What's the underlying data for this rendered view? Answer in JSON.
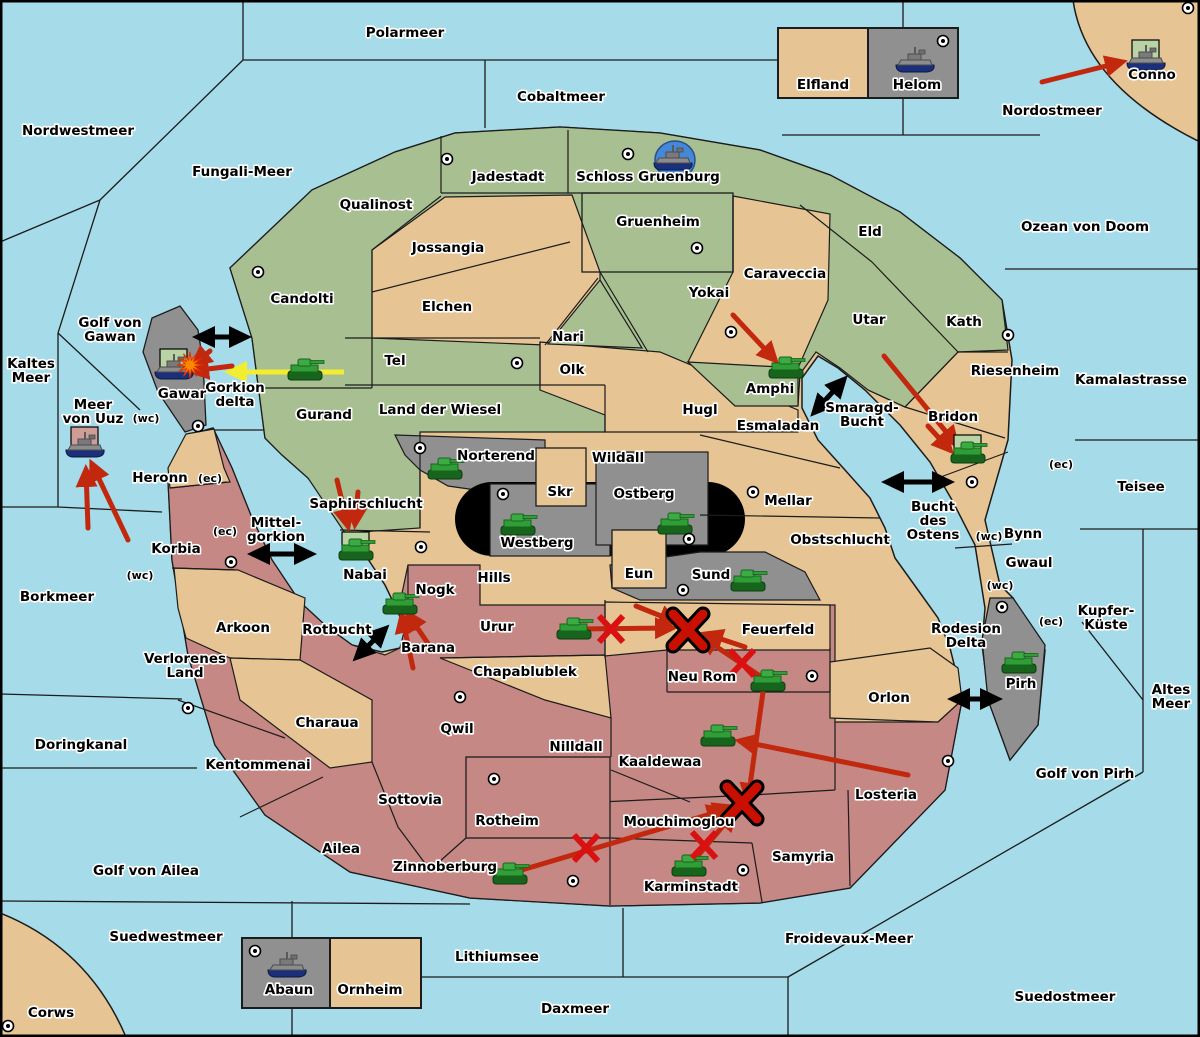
{
  "map": {
    "title": "Diplomacy-style war map",
    "colors": {
      "sea": "#a6dbe9",
      "land_tan": "#e6c493",
      "land_green": "#a8bf92",
      "land_pink": "#c58885",
      "land_gray": "#909090",
      "black_zone": "#000000",
      "border": "#1c1c1c",
      "arrow_red": "#c1280e",
      "arrow_yellow": "#f2ed2f",
      "arrow_black": "#000000",
      "x_mark": "#d91111",
      "x_mark_big": "#c90f00",
      "unit_box_green": "#b9d3a5",
      "unit_box_pink": "#cf9d97",
      "tank_green": "#2f9e36",
      "ship_gray": "#8c8c8c",
      "ship_hull_blue": "#1b2f7a",
      "port_circle_blue": "#4687d8",
      "explosion_orange": "#ff8a00"
    },
    "sea_labels": [
      {
        "t": [
          "Polarmeer"
        ],
        "x": 405,
        "y": 37
      },
      {
        "t": [
          "Nordwestmeer"
        ],
        "x": 78,
        "y": 135
      },
      {
        "t": [
          "Cobaltmeer"
        ],
        "x": 561,
        "y": 101
      },
      {
        "t": [
          "Nordostmeer"
        ],
        "x": 1052,
        "y": 115
      },
      {
        "t": [
          "Fungali-Meer"
        ],
        "x": 242,
        "y": 176
      },
      {
        "t": [
          "Ozean von Doom"
        ],
        "x": 1085,
        "y": 231
      },
      {
        "t": [
          "Golf von",
          "Gawan"
        ],
        "x": 110,
        "y": 327
      },
      {
        "t": [
          "Kaltes",
          "Meer"
        ],
        "x": 31,
        "y": 368
      },
      {
        "t": [
          "Meer",
          "von Uuz"
        ],
        "x": 93,
        "y": 409
      },
      {
        "t": [
          "Gorkion",
          "delta"
        ],
        "x": 235,
        "y": 392
      },
      {
        "t": [
          "Kamalastrasse"
        ],
        "x": 1131,
        "y": 384
      },
      {
        "t": [
          "Smaragd-",
          "Bucht"
        ],
        "x": 862,
        "y": 412
      },
      {
        "t": [
          "Teisee"
        ],
        "x": 1141,
        "y": 491
      },
      {
        "t": [
          "Bucht",
          "des",
          "Ostens"
        ],
        "x": 933,
        "y": 511
      },
      {
        "t": [
          "Mittel-",
          "gorkion"
        ],
        "x": 276,
        "y": 527
      },
      {
        "t": [
          "Borkmeer"
        ],
        "x": 57,
        "y": 601
      },
      {
        "t": [
          "Rotbucht"
        ],
        "x": 337,
        "y": 634
      },
      {
        "t": [
          "Rodesion",
          "Delta"
        ],
        "x": 966,
        "y": 633
      },
      {
        "t": [
          "Kupfer-",
          "Küste"
        ],
        "x": 1106,
        "y": 615
      },
      {
        "t": [
          "Altes",
          "Meer"
        ],
        "x": 1171,
        "y": 694
      },
      {
        "t": [
          "Doringkanal"
        ],
        "x": 81,
        "y": 749
      },
      {
        "t": [
          "Golf von Pirh"
        ],
        "x": 1085,
        "y": 778
      },
      {
        "t": [
          "Golf von Ailea"
        ],
        "x": 146,
        "y": 875
      },
      {
        "t": [
          "Suedwestmeer"
        ],
        "x": 166,
        "y": 941
      },
      {
        "t": [
          "Froidevaux-Meer"
        ],
        "x": 849,
        "y": 943
      },
      {
        "t": [
          "Lithiumsee"
        ],
        "x": 497,
        "y": 961
      },
      {
        "t": [
          "Daxmeer"
        ],
        "x": 575,
        "y": 1013
      },
      {
        "t": [
          "Corws"
        ],
        "x": 51,
        "y": 1017
      },
      {
        "t": [
          "Suedostmeer"
        ],
        "x": 1065,
        "y": 1001
      }
    ],
    "territory_labels": [
      {
        "t": [
          "Candolti"
        ],
        "x": 302,
        "y": 303,
        "color": "green"
      },
      {
        "t": [
          "Qualinost"
        ],
        "x": 376,
        "y": 209,
        "color": "green"
      },
      {
        "t": [
          "Jadestadt"
        ],
        "x": 508,
        "y": 181,
        "color": "green"
      },
      {
        "t": [
          "Schloss Gruenburg"
        ],
        "x": 648,
        "y": 181,
        "color": "green"
      },
      {
        "t": [
          "Gruenheim"
        ],
        "x": 658,
        "y": 226,
        "color": "green"
      },
      {
        "t": [
          "Jossangia"
        ],
        "x": 448,
        "y": 252,
        "color": "tan"
      },
      {
        "t": [
          "Elchen"
        ],
        "x": 447,
        "y": 311,
        "color": "tan"
      },
      {
        "t": [
          "Nari"
        ],
        "x": 568,
        "y": 341,
        "color": "green"
      },
      {
        "t": [
          "Olk"
        ],
        "x": 572,
        "y": 374,
        "color": "tan"
      },
      {
        "t": [
          "Tel"
        ],
        "x": 395,
        "y": 365,
        "color": "green"
      },
      {
        "t": [
          "Land der Wiesel"
        ],
        "x": 440,
        "y": 414,
        "color": "green"
      },
      {
        "t": [
          "Gurand"
        ],
        "x": 324,
        "y": 419,
        "color": "green"
      },
      {
        "t": [
          "Yokai"
        ],
        "x": 709,
        "y": 297,
        "color": "green"
      },
      {
        "t": [
          "Caraveccia"
        ],
        "x": 785,
        "y": 278,
        "color": "tan"
      },
      {
        "t": [
          "Eld"
        ],
        "x": 870,
        "y": 236,
        "color": "green"
      },
      {
        "t": [
          "Utar"
        ],
        "x": 869,
        "y": 324,
        "color": "green"
      },
      {
        "t": [
          "Kath"
        ],
        "x": 964,
        "y": 326,
        "color": "green"
      },
      {
        "t": [
          "Amphi"
        ],
        "x": 770,
        "y": 393,
        "color": "green"
      },
      {
        "t": [
          "Riesenheim"
        ],
        "x": 1015,
        "y": 375,
        "color": "tan"
      },
      {
        "t": [
          "Bridon"
        ],
        "x": 953,
        "y": 421,
        "color": "tan"
      },
      {
        "t": [
          "Bynn"
        ],
        "x": 1023,
        "y": 538,
        "color": "tan"
      },
      {
        "t": [
          "Gwaul"
        ],
        "x": 1029,
        "y": 567,
        "color": "tan"
      },
      {
        "t": [
          "Hugl"
        ],
        "x": 700,
        "y": 414,
        "color": "tan"
      },
      {
        "t": [
          "Esmaladan"
        ],
        "x": 778,
        "y": 430,
        "color": "tan"
      },
      {
        "t": [
          "Wildall"
        ],
        "x": 618,
        "y": 462,
        "color": "tan"
      },
      {
        "t": [
          "Mellar"
        ],
        "x": 788,
        "y": 505,
        "color": "tan"
      },
      {
        "t": [
          "Obstschlucht"
        ],
        "x": 840,
        "y": 544,
        "color": "tan"
      },
      {
        "t": [
          "Norterend"
        ],
        "x": 496,
        "y": 460,
        "color": "gray"
      },
      {
        "t": [
          "Skr"
        ],
        "x": 560,
        "y": 496,
        "color": "tan"
      },
      {
        "t": [
          "Ostberg"
        ],
        "x": 644,
        "y": 498,
        "color": "gray"
      },
      {
        "t": [
          "Westberg"
        ],
        "x": 537,
        "y": 547,
        "color": "gray"
      },
      {
        "t": [
          "Eun"
        ],
        "x": 639,
        "y": 578,
        "color": "tan"
      },
      {
        "t": [
          "Sund"
        ],
        "x": 711,
        "y": 579,
        "color": "gray"
      },
      {
        "t": [
          "Hills"
        ],
        "x": 494,
        "y": 582,
        "color": "tan"
      },
      {
        "t": [
          "Saphirschlucht"
        ],
        "x": 366,
        "y": 508,
        "color": "green"
      },
      {
        "t": [
          "Nabai"
        ],
        "x": 365,
        "y": 579,
        "color": "tan"
      },
      {
        "t": [
          "Heronn"
        ],
        "x": 160,
        "y": 482,
        "color": "tan"
      },
      {
        "t": [
          "Korbia"
        ],
        "x": 176,
        "y": 553,
        "color": "pink"
      },
      {
        "t": [
          "Gawar"
        ],
        "x": 182,
        "y": 398,
        "color": "gray"
      },
      {
        "t": [
          "Nogk"
        ],
        "x": 435,
        "y": 594,
        "color": "pink"
      },
      {
        "t": [
          "Barana"
        ],
        "x": 428,
        "y": 652,
        "color": "pink"
      },
      {
        "t": [
          "Urur"
        ],
        "x": 497,
        "y": 631,
        "color": "pink"
      },
      {
        "t": [
          "Chapablublek"
        ],
        "x": 525,
        "y": 676,
        "color": "tan"
      },
      {
        "t": [
          "Feuerfeld"
        ],
        "x": 778,
        "y": 634,
        "color": "tan"
      },
      {
        "t": [
          "Neu Rom"
        ],
        "x": 702,
        "y": 681,
        "color": "pink"
      },
      {
        "t": [
          "Arkoon"
        ],
        "x": 243,
        "y": 632,
        "color": "tan"
      },
      {
        "t": [
          "Verlorenes",
          "Land"
        ],
        "x": 185,
        "y": 663,
        "color": "pink"
      },
      {
        "t": [
          "Kentommenai"
        ],
        "x": 258,
        "y": 769,
        "color": "pink"
      },
      {
        "t": [
          "Charaua"
        ],
        "x": 327,
        "y": 727,
        "color": "tan"
      },
      {
        "t": [
          "Qwil"
        ],
        "x": 457,
        "y": 733,
        "color": "pink"
      },
      {
        "t": [
          "Nilldall"
        ],
        "x": 576,
        "y": 751,
        "color": "pink"
      },
      {
        "t": [
          "Kaaldewaa"
        ],
        "x": 660,
        "y": 766,
        "color": "pink"
      },
      {
        "t": [
          "Sottovia"
        ],
        "x": 410,
        "y": 804,
        "color": "pink"
      },
      {
        "t": [
          "Ailea"
        ],
        "x": 341,
        "y": 853,
        "color": "pink"
      },
      {
        "t": [
          "Rotheim"
        ],
        "x": 507,
        "y": 825,
        "color": "pink"
      },
      {
        "t": [
          "Zinnoberburg"
        ],
        "x": 445,
        "y": 871,
        "color": "pink"
      },
      {
        "t": [
          "Karminstadt"
        ],
        "x": 691,
        "y": 891,
        "color": "pink"
      },
      {
        "t": [
          "Mouchimoglou"
        ],
        "x": 679,
        "y": 826,
        "color": "pink"
      },
      {
        "t": [
          "Samyria"
        ],
        "x": 803,
        "y": 861,
        "color": "pink"
      },
      {
        "t": [
          "Orlon"
        ],
        "x": 889,
        "y": 702,
        "color": "tan"
      },
      {
        "t": [
          "Losteria"
        ],
        "x": 886,
        "y": 799,
        "color": "pink"
      },
      {
        "t": [
          "Pirh"
        ],
        "x": 1021,
        "y": 688,
        "color": "gray"
      },
      {
        "t": [
          "Conno"
        ],
        "x": 1152,
        "y": 79,
        "color": "tan"
      },
      {
        "t": [
          "Elfland"
        ],
        "x": 823,
        "y": 89,
        "color": "tan"
      },
      {
        "t": [
          "Helom"
        ],
        "x": 917,
        "y": 89,
        "color": "gray"
      },
      {
        "t": [
          "Abaun"
        ],
        "x": 289,
        "y": 994,
        "color": "gray"
      },
      {
        "t": [
          "Ornheim"
        ],
        "x": 370,
        "y": 994,
        "color": "tan"
      }
    ],
    "coast_marks": [
      {
        "t": "(wc)",
        "x": 146,
        "y": 422
      },
      {
        "t": "(ec)",
        "x": 210,
        "y": 482
      },
      {
        "t": "(ec)",
        "x": 225,
        "y": 535
      },
      {
        "t": "(wc)",
        "x": 140,
        "y": 579
      },
      {
        "t": "(ec)",
        "x": 1061,
        "y": 468
      },
      {
        "t": "(wc)",
        "x": 989,
        "y": 540
      },
      {
        "t": "(wc)",
        "x": 1000,
        "y": 589
      },
      {
        "t": "(ec)",
        "x": 1051,
        "y": 625
      }
    ],
    "supply_centers": [
      [
        447,
        159
      ],
      [
        628,
        154
      ],
      [
        943,
        41
      ],
      [
        1188,
        8
      ],
      [
        258,
        272
      ],
      [
        697,
        248
      ],
      [
        731,
        332
      ],
      [
        1008,
        335
      ],
      [
        517,
        363
      ],
      [
        198,
        426
      ],
      [
        420,
        448
      ],
      [
        503,
        494
      ],
      [
        689,
        539
      ],
      [
        753,
        492
      ],
      [
        972,
        482
      ],
      [
        683,
        590
      ],
      [
        421,
        547
      ],
      [
        231,
        562
      ],
      [
        1002,
        607
      ],
      [
        460,
        697
      ],
      [
        188,
        708
      ],
      [
        494,
        779
      ],
      [
        812,
        676
      ],
      [
        948,
        761
      ],
      [
        743,
        870
      ],
      [
        573,
        881
      ],
      [
        255,
        951
      ],
      [
        8,
        1026
      ]
    ],
    "units": {
      "tanks": [
        {
          "name": "Gurand",
          "x": 305,
          "y": 372
        },
        {
          "name": "Norterend",
          "x": 445,
          "y": 471
        },
        {
          "name": "Westberg",
          "x": 518,
          "y": 527
        },
        {
          "name": "Ostberg",
          "x": 675,
          "y": 526
        },
        {
          "name": "Sund",
          "x": 748,
          "y": 583
        },
        {
          "name": "Nabai",
          "x": 356,
          "y": 552,
          "box": "green"
        },
        {
          "name": "Nogk",
          "x": 400,
          "y": 606
        },
        {
          "name": "Urur",
          "x": 574,
          "y": 631
        },
        {
          "name": "Neu Rom",
          "x": 768,
          "y": 683
        },
        {
          "name": "Amphi",
          "x": 786,
          "y": 370
        },
        {
          "name": "Bridon",
          "x": 968,
          "y": 455,
          "box": "green"
        },
        {
          "name": "Pirh",
          "x": 1019,
          "y": 665
        },
        {
          "name": "Kaaldewaa",
          "x": 718,
          "y": 738
        },
        {
          "name": "Zinnoberburg",
          "x": 510,
          "y": 876
        },
        {
          "name": "Karminstadt",
          "x": 689,
          "y": 868
        }
      ],
      "ships": [
        {
          "name": "Schloss Gruenburg",
          "x": 673,
          "y": 160,
          "circle": true
        },
        {
          "name": "Helom",
          "x": 915,
          "y": 62
        },
        {
          "name": "Conno",
          "x": 1146,
          "y": 60,
          "box": "green"
        },
        {
          "name": "Gawar",
          "x": 174,
          "y": 369,
          "box": "green",
          "explosion": true
        },
        {
          "name": "Meer von Uuz",
          "x": 85,
          "y": 447,
          "box": "pink"
        },
        {
          "name": "Abaun",
          "x": 287,
          "y": 967
        }
      ]
    },
    "arrows": {
      "red": [
        [
          1042,
          82,
          1122,
          62
        ],
        [
          733,
          315,
          775,
          360
        ],
        [
          884,
          356,
          956,
          444
        ],
        [
          928,
          426,
          950,
          450
        ],
        [
          232,
          366,
          192,
          371
        ],
        [
          210,
          351,
          194,
          364
        ],
        [
          128,
          540,
          92,
          464
        ],
        [
          88,
          528,
          86,
          470
        ],
        [
          337,
          480,
          348,
          526
        ],
        [
          358,
          492,
          355,
          524
        ],
        [
          413,
          668,
          402,
          616
        ],
        [
          431,
          648,
          408,
          614
        ],
        [
          578,
          629,
          672,
          628
        ],
        [
          636,
          606,
          676,
          622
        ],
        [
          763,
          678,
          702,
          637
        ],
        [
          745,
          647,
          706,
          634
        ],
        [
          908,
          775,
          740,
          741
        ],
        [
          515,
          872,
          724,
          810
        ],
        [
          696,
          858,
          734,
          813
        ],
        [
          763,
          692,
          748,
          800
        ],
        [
          688,
          822,
          730,
          807
        ]
      ],
      "yellow": [
        [
          344,
          372,
          230,
          372
        ]
      ],
      "straits": [
        {
          "x": 222,
          "y": 337,
          "a": 0,
          "l": 48
        },
        {
          "x": 282,
          "y": 554,
          "a": 0,
          "l": 58
        },
        {
          "x": 371,
          "y": 643,
          "a": -45,
          "l": 40
        },
        {
          "x": 829,
          "y": 396,
          "a": -48,
          "l": 44
        },
        {
          "x": 918,
          "y": 482,
          "a": 0,
          "l": 62
        },
        {
          "x": 975,
          "y": 699,
          "a": 0,
          "l": 44
        }
      ]
    },
    "battle_marks": {
      "small_x": [
        [
          611,
          629
        ],
        [
          742,
          663
        ],
        [
          586,
          848
        ],
        [
          704,
          845
        ]
      ],
      "large_x": [
        [
          688,
          630
        ],
        [
          742,
          803
        ]
      ]
    }
  }
}
